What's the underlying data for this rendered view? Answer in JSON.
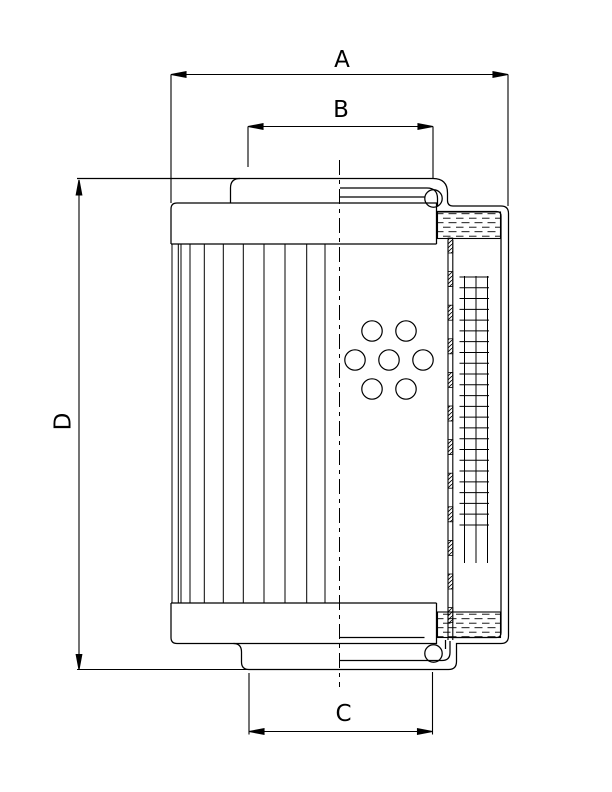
{
  "drawing": {
    "type": "technical-section-drawing",
    "subject": "filter-element-cross-section",
    "background_color": "#ffffff",
    "line_color": "#000000"
  },
  "dimensions": {
    "a": "A",
    "b": "B",
    "c": "C",
    "d": "D"
  }
}
